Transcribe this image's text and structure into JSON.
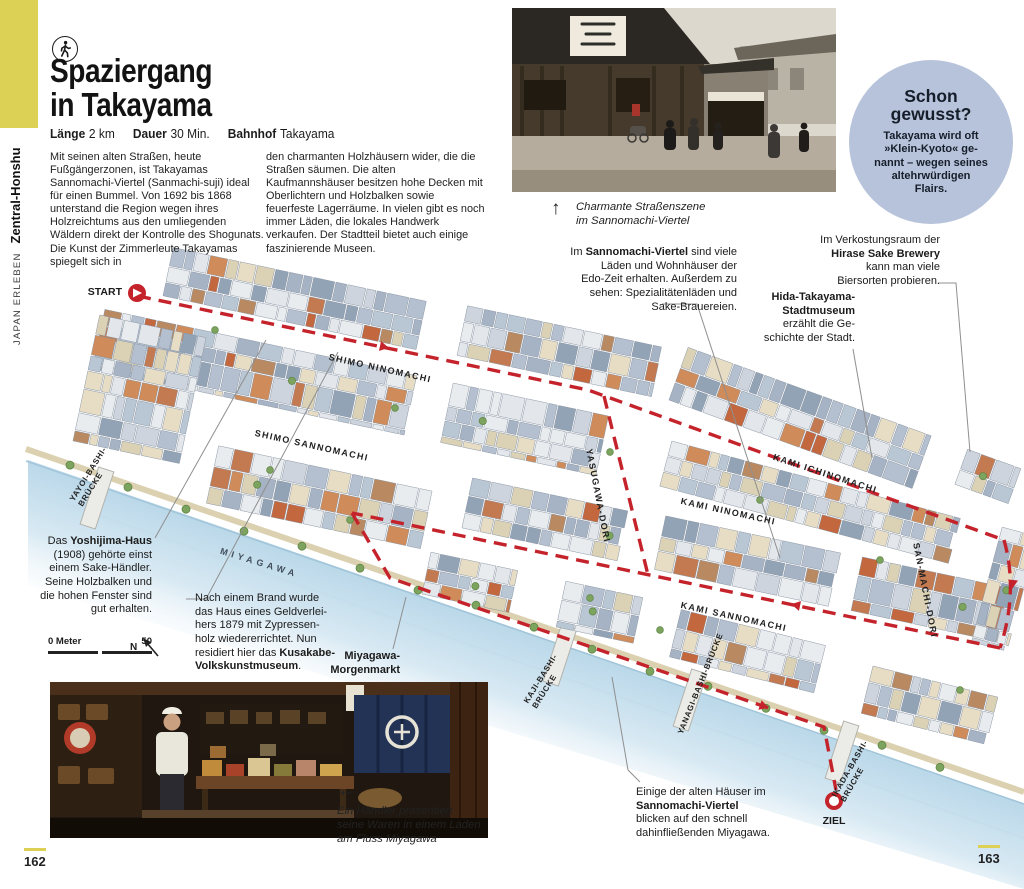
{
  "sidebar": {
    "section": "JAPAN ERLEBEN",
    "region": "Zentral-Honshu"
  },
  "header": {
    "title_line1": "Spaziergang",
    "title_line2": "in Takayama",
    "meta": [
      {
        "label": "Länge",
        "value": "2 km"
      },
      {
        "label": "Dauer",
        "value": "30 Min."
      },
      {
        "label": "Bahnhof",
        "value": "Takayama"
      }
    ]
  },
  "intro": {
    "col1": "Mit seinen alten Straßen, heute Fußgängerzonen, ist Takayamas Sannomachi-Viertel (Sanmachi-suji) ideal für einen Bummel. Von 1692 bis 1868 unterstand die Region wegen ihres Holzreichtums aus den umliegenden Wäldern direkt der Kontrolle des Shogunats. Die Kunst der Zimmerleute Takayamas spiegelt sich in",
    "col2": "den charmanten Holzhäusern wider, die die Straßen säumen. Die alten Kaufmannshäuser besitzen hohe Decken mit Oberlichtern und Holzbalken sowie feuerfeste Lagerräume. In vielen gibt es noch immer Läden, die lokales Handwerk verkaufen. Der Stadtteil bietet auch einige faszinierende Museen."
  },
  "photo_top": {
    "arrow": "↑",
    "caption": "Charmante Straßenszene\nim Sannomachi-Viertel"
  },
  "did_you_know": {
    "title": "Schon\ngewusst?",
    "text": "Takayama wird oft\n»Klein-Kyoto« ge-\nnannt – wegen seines\naltehrwürdigen\nFlairs."
  },
  "annotations": {
    "sannomachi": {
      "pre": "Im ",
      "bold": "Sannomachi-Viertel",
      "post": " sind viele\nLäden und Wohnhäuser der\nEdo-Zeit erhalten. Außerdem zu\nsehen: Spezialitätenläden und\nSake-Brauereien."
    },
    "hirase": {
      "pre": "Im Verkostungsraum der\n",
      "bold": "Hirase Sake Brewery",
      "post": "\nkann man viele\nBiersorten probieren."
    },
    "hida": {
      "bold": "Hida-Takayama-\nStadtmuseum",
      "post": "\nerzählt die Ge-\nschichte der Stadt."
    },
    "yoshijima": {
      "pre": "Das ",
      "bold": "Yoshijima-Haus",
      "post": "\n(1908) gehörte einst\neinem Sake-Händler.\nSeine Holzbalken und\ndie hohen Fenster sind\ngut erhalten."
    },
    "kusakabe": {
      "pre": "Nach einem Brand wurde\ndas Haus eines Geldverlei-\nhers 1879 mit Zypressen-\nholz wiedererrichtet. Nun\nresidiert hier das ",
      "bold": "Kusakabe-\nVolkskunstmuseum",
      "post": "."
    },
    "morgenmarkt": {
      "bold": "Miyagawa-\nMorgenmarkt"
    },
    "einige": {
      "pre": "Einige der alten Häuser im\n",
      "bold": "Sannomachi-Viertel",
      "post": "\nblicken auf den schnell\ndahinfließenden Miyagawa."
    }
  },
  "map": {
    "start_label": "START",
    "ziel_label": "ZIEL",
    "river_label": "MIYAGAWA",
    "streets": {
      "shimo_ninomachi": "SHIMO NINOMACHI",
      "shimo_sannomachi": "SHIMO SANNOMACHI",
      "kami_ichinomachi": "KAMI ICHINOMACHI",
      "kami_ninomachi": "KAMI NINOMACHI",
      "kami_sannomachi": "KAMI SANNOMACHI",
      "yasugawa_dori": "YASUGAWA-DORI",
      "san_machi_dori": "SAN-MACHI-DORI"
    },
    "bridges": {
      "yayoi": "YAYOI-BASHI-\nBRÜCKE",
      "kaji": "KAJI-BASHI-\nBRÜCKE",
      "yanagi": "YANAGI-BASHI-BRÜCKE",
      "ikada": "IKADA-BASHI-\nBRÜCKE"
    },
    "scale": {
      "zero_label": "0 Meter",
      "end_label": "50",
      "north": "N"
    }
  },
  "photo_bottom": {
    "arrow": "←",
    "caption": "Ein Händler präsentiert\nseine Waren in einem Laden\nam Fluss Miyagawa"
  },
  "footer": {
    "left_page": "162",
    "right_page": "163"
  },
  "colors": {
    "accent_yellow": "#ddd155",
    "route_red": "#c5232b",
    "bubble_blue": "#b7c3da",
    "river_blue": "#bcd9ea"
  }
}
